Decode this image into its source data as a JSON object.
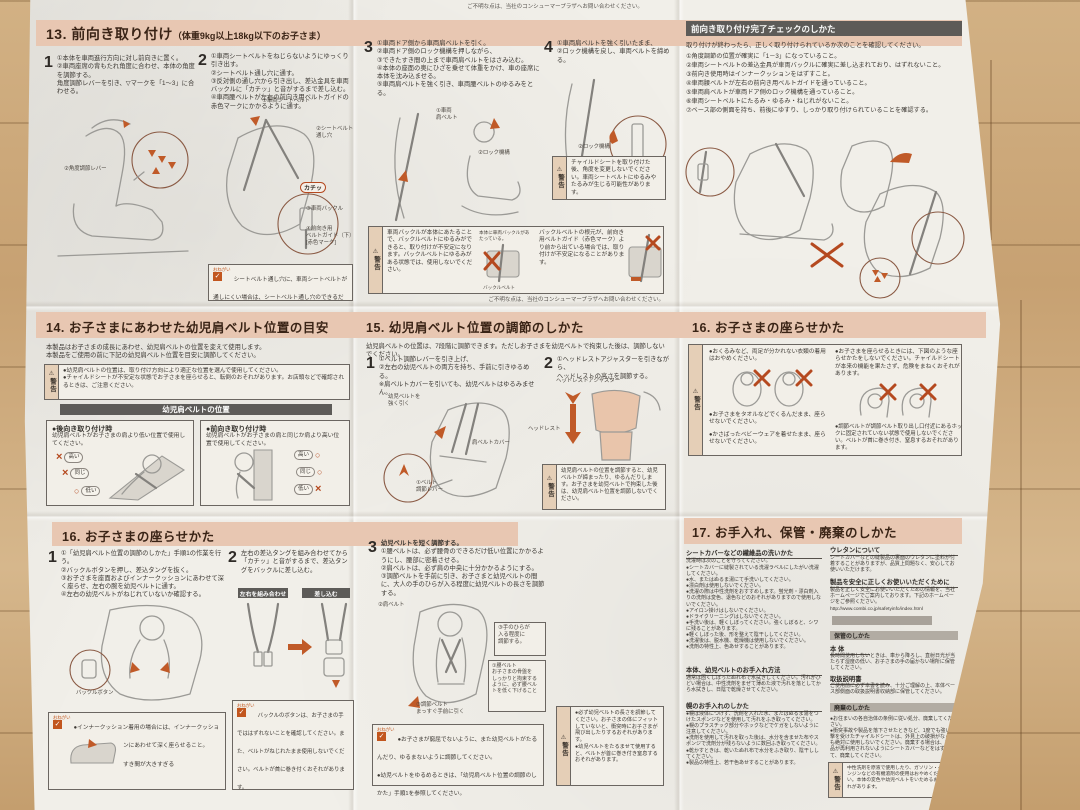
{
  "meta": {
    "warn_label": "警告",
    "onegai_label": "おねがい",
    "check_glyph": "✓"
  },
  "notes": {
    "top": "ご不明な点は、当社のコンシューマープラザへお問い合わせください。",
    "mid": "ご不明な点は、当社のコンシューマープラザへお問い合わせください。"
  },
  "s13": {
    "title": "13. 前向き取り付け",
    "subtitle": "（体重9kg以上18kg以下のお子さま）",
    "n1": "1",
    "t1": "①本体を車両進行方向に対し前向きに置く。\n②車両座席の背もたれ角度に合わせ、本体の角度を調節する。\n角度調節レバーを引き、▽マークを「1～3」に合わせる。",
    "n2": "2",
    "t2": "①車両シートベルトをねじらないようにゆっくり引き出す。\n②シートベルト通し穴に通す。\n③反対側の通し穴から引き出し、差込金具を車両バックルに「カチッ」と音がするまで差し込む。\n④車両腰ベルトが左右の前向き用ベルトガイドの赤色マークにかかるように通す。",
    "n3": "3",
    "t3": "①車両ドア側から車両肩ベルトを引く。\n②車両ドア側のロック機構を押しながら、\n③できたすき間の上まで車両肩ベルトをはさみ込む。\n④本体の座面の奥にひざを乗せて体重をかけ、車の座席に本体を沈み込ませる。\n⑤車両肩ベルトを強く引き、車両腰ベルトのゆるみをとる。",
    "n4": "4",
    "t4": "①車両肩ベルトを強く引いたまま、\n②ロック機構を戻し、車両ベルトを締める。",
    "lbl_lever": "②角度調節レバー",
    "lbl_seatbelt": "①車両シートベルト",
    "lbl_slot": "②シートベルト\n通し穴",
    "lbl_click": "カチッ",
    "lbl_buckle": "③車両バックル",
    "lbl_guide": "④前向き用\nベルトガイド（下）\n[赤色マーク]",
    "lbl_shoulder": "①車両\n肩ベルト",
    "lbl_lock": "②ロック機構",
    "lbl_lock4": "②ロック機構",
    "onegai": "シートベルト通し穴に、車両シートベルトが通しにくい場合は、シートベルト通し穴のできるだけ下を通してください。",
    "warn_angle": "チャイルドシートを取り付けた後、角度を変更しないでください。車両シートベルトにゆるみやたるみが生じる可能性があります。",
    "warn_a": "車両バックルが本体にあたることで、バックルベルトにゆるみができると、取り付けが不安定になります。バックルベルトにゆるみがある状態では、使用しないでください。",
    "warn_a_cap": "本体に車両バックルがあたっている。",
    "warn_a_cap2": "バックルベルト",
    "warn_b": "バックルベルトの根元が、前向き用ベルトガイド（赤色マーク）より前から出ている場合では、取り付けが不安定になることがあります。"
  },
  "check": {
    "header": "前向き取り付け完了チェックのしかた",
    "intro": "取り付けが終わったら、正しく取り付けられているか次のことを確認してください。",
    "items": [
      "①角度調節の位置が確実に「1－3」になっていること。",
      "②車両シートベルトの差込金具が車両バックルに確実に差し込まれており、はずれないこと。",
      "③前向き使用時はインナークッションをはずすこと。",
      "④車両腰ベルトが左右の前向き用ベルトガイドを通っていること。",
      "⑤車両肩ベルトが車両ドア側のロック機構を通っていること。",
      "⑥車両シートベルトにたるみ・ゆるみ・ねじれがないこと。",
      "⑦ベース部の側面を持ち、前後にゆすり、しっかり取り付けられていることを確認する。"
    ]
  },
  "s14": {
    "title": "14. お子さまにあわせた幼児肩ベルト位置の目安",
    "intro": "本製品はお子さまの成長にあわせ、幼児肩ベルトの位置を変えて使用します。\n本製品をご使用の前に下記の幼児肩ベルト位置を目安に調節してください。",
    "warn": "●幼児肩ベルトの位置は、取り付け方向により適正な位置を選んで使用してください。\n●チャイルドシートが不安定な状態でお子さまを座らせると、転倒のおそれがあります。お店頭などで確認されるときは、ご注意ください。",
    "bar": "幼児肩ベルトの位置",
    "b1_title": "●後向き取り付け時",
    "b1_text": "幼児肩ベルトがお子さまの肩より低い位置で使用してください。",
    "b2_title": "●前向き取り付け時",
    "b2_text": "幼児肩ベルトがお子さまの肩と同じか肩より高い位置で使用してください。",
    "hi": "高い",
    "same": "同じ",
    "low": "低い",
    "x": "×",
    "o": "○"
  },
  "s15": {
    "title": "15. 幼児肩ベルト位置の調節のしかた",
    "intro": "幼児肩ベルトの位置は、7段階に調節できます。ただしお子さまを幼児ベルトで拘束した後は、調節しないでください。",
    "n1": "1",
    "t1": "①ベルト調節レバーを引き上げ、\n②左右の幼児ベルトの両方を持ち、手前に引きゆるめる。\n※肩ベルトカバーを引いても、幼児ベルトはゆるみません。",
    "n2": "2",
    "t2": "①ヘッドレストアジャスターを引きながら、\nヘッドレストの高さを調節する。",
    "lbl_pull": "幼児ベルトを\n強く引く",
    "lbl_cover": "肩ベルトカバー",
    "lbl_lever": "①ベルト\n調節レバー",
    "lbl_adjuster": "ヘッドレストアジャスター",
    "lbl_headrest": "ヘッドレスト",
    "warn": "幼児肩ベルトの位置を調節すると、幼児ベルトが締まったり、ゆるんだりします。お子さまを幼児ベルトで拘束した後は、幼児肩ベルト位置を調節しないでください。"
  },
  "s16a": {
    "title": "16. お子さまの座らせかた",
    "b1": "●おくるみなど、両足が分かれない衣類の着用はおやめください。",
    "b2": "●お子さまをタオルなどでくるんだまま、座らせないでください。",
    "b3": "●かさばったベビーウェアを着せたまま、座らせないでください。",
    "b4": "●お子さまを座らせるときには、下図のような座らせかたをしないでください。チャイルドシートが本来の機能を果たさず、危険をまねくおそれがあります。",
    "b5": "●調節ベルトが調節ベルト取り出し口付近にあるホックに固定されていない状態で使用しないでください。ベルトが首に巻き付き、窒息するおそれがあります。"
  },
  "s16b": {
    "title": "16. お子さまの座らせかた",
    "n1": "1",
    "t1": "①「幼児肩ベルト位置の調節のしかた」手順1の作業を行う。\n②バックルボタンを押し、差込タングを抜く。\n③お子さまを座面およびインナークッションにあわせて深く座らせ、左右の腕を幼児ベルトに通す。\n④左右の幼児ベルトがねじれていないか確認する。",
    "lbl_bbtn": "バックルボタン",
    "onegai1": "●インナークッション着用の場合には、インナークッションにあわせて深く座らせること。",
    "onegai1_cap": "すき間が大きすぎる",
    "n2": "2",
    "t2": "左右の差込タングを組み合わせてから「カチッ」と音がするまで、差込タングをバックルに差し込む。",
    "bar_a": "左右を組み合わせ",
    "bar_b": "差し込む",
    "onegai2": "バックルのボタンは、お子さまの手でははずれないことを確認してください。また、ベルトがねじれたまま使用しないでください。ベルトが首に巻き付くおそれがあります。",
    "n3": "3",
    "t3_title": "幼児ベルトを短く調節する。",
    "t3": "①腰ベルトは、必ず腰骨のできるだけ低い位置にかかるようにし、腰部に密着させる。\n②肩ベルトは、必ず肩の中央に十分かかるようにする。\n③調節ベルトを手前に引き、お子さまと幼児ベルトの間に、大人の手のひらが入る程度に幼児ベルトの長さを調節する。",
    "lbl_shoulder": "②肩ベルト",
    "callout_palm": "③手のひらが\n入る程度に\n調節する。",
    "callout_waist": "①腰ベルト\nお子さまの骨盤を\nしっかりと拘束する\nように、必ず腰ベル\nトを低く下げること",
    "lbl_adjust": "③調節ベルト\nまっすぐ手前に引く",
    "onegai3": "●お子さまが窮屈でないように、また幼児ベルトがたるんだり、ゆるまないように調節してください。\n●幼児ベルトをゆるめるときは、「幼児肩ベルト位置の調節のしかた」手順1を参照してください。",
    "warn": "●必ず幼児ベルトの長さを調節してください。お子さまの体にフィットしていないと、衝突時にお子さまが飛び出したりするおそれがあります。\n●幼児ベルトをたるませて使用すると、ベルトが首に巻き付き窒息するおそれがあります。"
  },
  "s17": {
    "title": "17. お手入れ、保管・廃棄のしかた",
    "h_wash": "シートカバーなどの繊維品の洗いかた",
    "wash_intro": "洗濯時は次のことを守ってください。",
    "wash_items": [
      "●シートカバーに縫製されている洗濯ラベルにしたがい洗濯してください。",
      "●水、またはぬるま湯にて手洗いしてください。",
      "●漂白剤は使用しないでください。",
      "●洗濯の際は中性洗剤をおすすめします。蛍光剤・漂白剤入りの洗剤は変色、退色などのおそれがありますので使用しないでください。",
      "●アイロン掛けはしないでください。",
      "●ドライクリーニングはしないでください。",
      "●手洗い後は、軽くしぼってください。強くしぼると、シワに残ることがあります。",
      "●軽くしぼった後、形を整えて陰干ししてください。",
      "●洗濯後は、脱水機、乾燥機は使用しないでください。",
      "●洗剤の特性上、色あせすることがあります。"
    ],
    "h_body": "本体、幼児ベルトのお手入れ方法",
    "body_text": "通常は固くしぼったぬれ布で水拭きしてください。汚れがひどい場合は、中性洗剤をまぜて薄めた液で汚れを落としてから水拭きし、日陰で乾燥させてください。",
    "h_hood": "幌のお手入れのしかた",
    "hood_items": [
      "●幌は液体につけず、洗剤を入れた水、またはぬるま湯をつけたスポンジなどを使用して汚れをふき取ってください。",
      "●幌のプラスチック部分やホックなどでケガをしないように注意してください。",
      "●洗剤を使用して汚れを取った後は、水分を含ませた布やスポンジで洗剤分が残らないように数回ふき取ってください。",
      "●乾かすときは、乾いたぬれ布で水分をふき取り、陰干ししてください。",
      "●製品の特性上、若干色あせすることがあります。"
    ],
    "h_urethane": "ウレタンについて",
    "urethane_text": "シートカバーなどの縫製品の裏面のウレタンに塗料が付着することがありますが、品質上問題なく、安心してお使いいただけます。",
    "h_safety": "製品を安全に正しくお使いいただくために",
    "safety_text": "製品を正しく安全にお使いいただくための情報を、当社ホームページでご案内しております。下記のホームページをご参照ください。",
    "url": "http://www.combi.co.jp/safetyinfo/index.html",
    "h_storage": "保管のしかた",
    "h_unit": "本 体",
    "unit_text": "長時間使用しないときは、車から降ろし、直射日光が当たらず湿度の低い、お子さまの手の届かない場所に保管してください。",
    "h_manual": "取扱説明書",
    "manual_text": "ご使用前に必ず本書を読み、十分ご理解の上、本体ベース部側面の取扱説明書収納部に保管してください。",
    "h_disposal": "廃棄のしかた",
    "disposal_items": [
      "●お住まいの各自治体の条例に従い処分、廃棄してください。",
      "●衝突事故や製品を落下させたときなど、1度でも強い衝撃を受けたチャイルドシートは、外見上の破損がなくても絶対に使用しないでください。廃棄する場合は、本製品が再利用されないようにシートカバーなどをはずして、廃棄してください。"
    ],
    "warn": "中性洗剤を原液で使用したり、ガソリン・ベンジンなどの有機溶剤の使用はおやめください。本体の変色や幼児ベルトをいためるおそれがあります。"
  }
}
